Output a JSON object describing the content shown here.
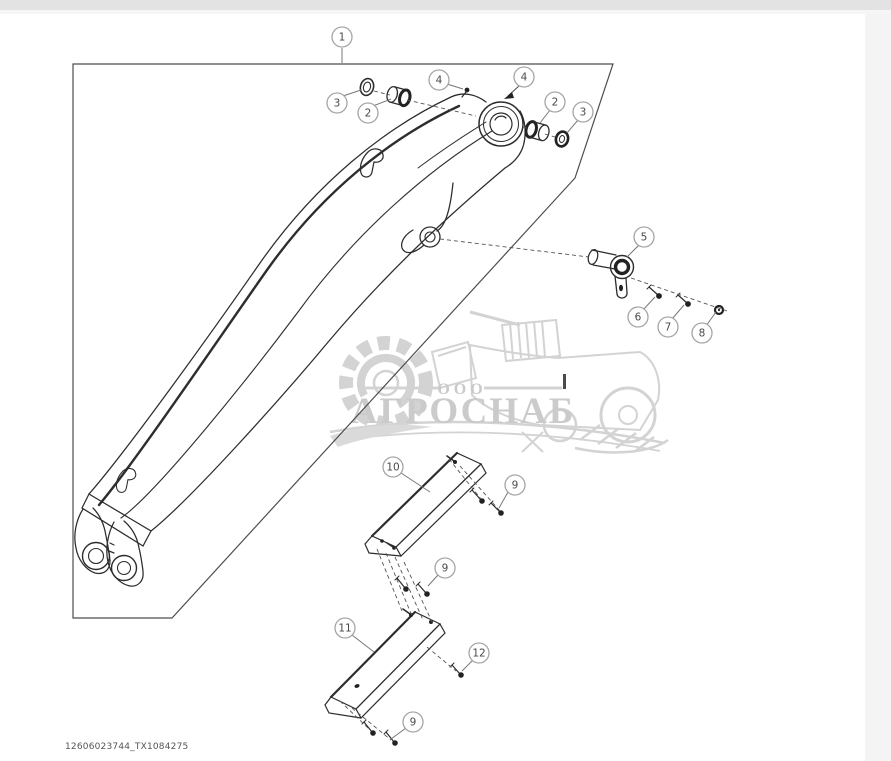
{
  "page": {
    "footer_code": "12606023744_TX1084275",
    "colors": {
      "line": "#2d2d2d",
      "watermark": "#d3d3d3",
      "balloon_stroke": "#a5a5a5",
      "top_edge_strip": "#e3e3e3",
      "right_margin_bar": "#f4f4f4",
      "background": "#ffffff"
    }
  },
  "watermark": {
    "company_prefix": "ООО",
    "brand": "АГРОСНАБ"
  },
  "diagram": {
    "description": "Exploded parts view of excavator boom arm with bushings, pivot pin, fasteners and wear plates",
    "callouts": [
      {
        "label": "1",
        "x": 342,
        "y": 37
      },
      {
        "label": "3",
        "x": 337,
        "y": 103
      },
      {
        "label": "2",
        "x": 368,
        "y": 113
      },
      {
        "label": "4",
        "x": 439,
        "y": 80
      },
      {
        "label": "4",
        "x": 524,
        "y": 77
      },
      {
        "label": "2",
        "x": 555,
        "y": 102
      },
      {
        "label": "3",
        "x": 583,
        "y": 112
      },
      {
        "label": "5",
        "x": 644,
        "y": 237
      },
      {
        "label": "6",
        "x": 638,
        "y": 317
      },
      {
        "label": "7",
        "x": 668,
        "y": 327
      },
      {
        "label": "8",
        "x": 702,
        "y": 333
      },
      {
        "label": "10",
        "x": 393,
        "y": 467
      },
      {
        "label": "9",
        "x": 515,
        "y": 485
      },
      {
        "label": "9",
        "x": 445,
        "y": 568
      },
      {
        "label": "11",
        "x": 345,
        "y": 628
      },
      {
        "label": "12",
        "x": 479,
        "y": 653
      },
      {
        "label": "9",
        "x": 413,
        "y": 722
      }
    ]
  }
}
